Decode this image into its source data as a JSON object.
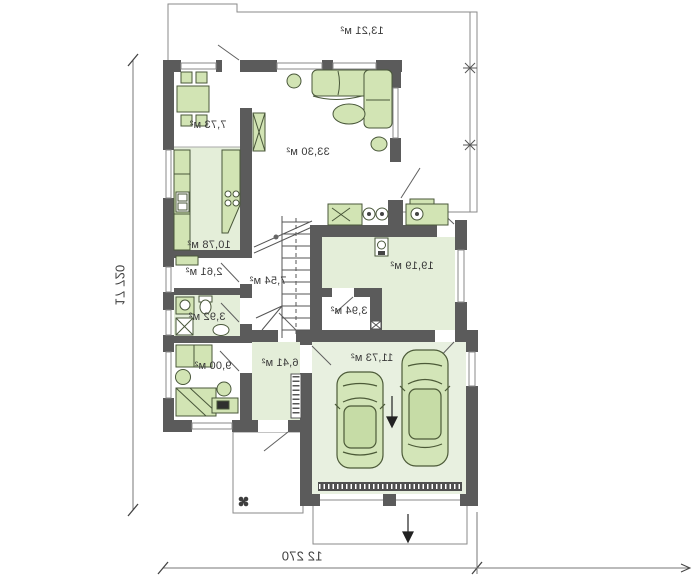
{
  "plan": {
    "type": "floor-plan",
    "mirrored": true,
    "rooms": {
      "terrace": {
        "label": "13,21 м²"
      },
      "dining": {
        "label": "7,73 м²"
      },
      "living": {
        "label": "33,30 м²"
      },
      "kitchen": {
        "label": "10,78 м²"
      },
      "pantry": {
        "label": "2,61 м²"
      },
      "bathroom": {
        "label": "3,92 м²"
      },
      "hall_stairs province": {
        "label": ""
      },
      "hall_stairs": {
        "label": "7,54 м²"
      },
      "room": {
        "label": "9,00 м²"
      },
      "vestibule": {
        "label": "6,41 м²"
      },
      "utility": {
        "label": "19,19 м²"
      },
      "storage": {
        "label": "3,94 м²"
      },
      "garage": {
        "label": "11,73 м²"
      }
    },
    "dimensions": {
      "depth": "17 720",
      "width": "12 270"
    },
    "colors": {
      "wall": "#5b5b5b",
      "room_fill": "#e4eed9",
      "garage_fill": "#e8f0e0",
      "furniture_fill": "#d2e4b4",
      "furniture_stroke": "#49573a",
      "site_line": "#8a8a8a"
    }
  }
}
